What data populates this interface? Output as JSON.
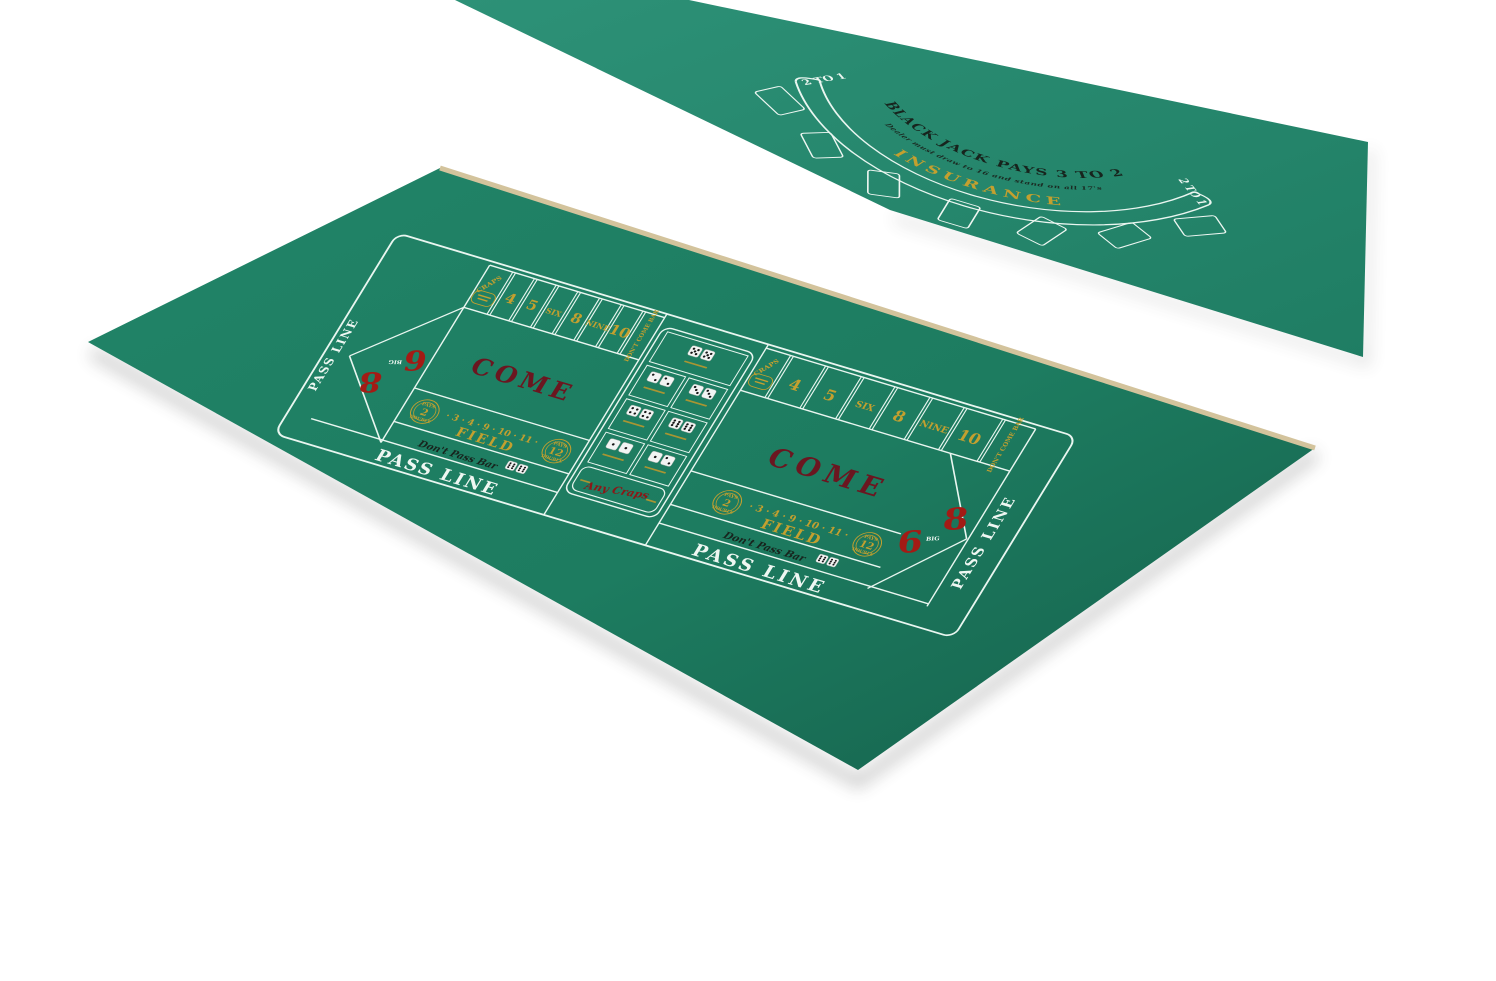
{
  "product": {
    "description": "Double-sided green felt casino tabletop layout: blackjack half and craps half"
  },
  "colors": {
    "background": "#ffffff",
    "blackjack_felt": "#23856a",
    "blackjack_felt_light": "#2d9177",
    "craps_felt": "#1d7c60",
    "craps_felt_dark": "#15604b",
    "line_white": "#e9f6f0",
    "gold": "#c3a02f",
    "red": "#a31b15",
    "maroon": "#6b1620",
    "print_black": "#17241d",
    "tan_edge": "#d3c39c",
    "dice_white": "#f2f4f3",
    "pip_black": "#161616"
  },
  "blackjack": {
    "title": "BLACK JACK PAYS 3 TO 2",
    "rule": "Dealer must draw to 16 and stand on all 17's",
    "insurance": "INSURANCE",
    "insurance_payout_left": "2 TO 1",
    "insurance_payout_right": "2 TO 1",
    "betting_spot_count": 7
  },
  "craps": {
    "pass_line": "PASS LINE",
    "come": "COME",
    "field_label": "FIELD",
    "field_numbers": "· 3 · 4 · 9 · 10 · 11 ·",
    "field_circle_left": {
      "pays": "PAYS",
      "value": "2",
      "double": "DOUBLE"
    },
    "field_circle_right": {
      "pays": "PAYS",
      "value": "12",
      "double": "DOUBLE"
    },
    "place_numbers": [
      "4",
      "5",
      "SIX",
      "8",
      "NINE",
      "10"
    ],
    "craps_box": "CRAPS",
    "dont_come": "DON'T COME BAR",
    "dont_pass": "Don't Pass Bar",
    "any_craps": "Any Craps",
    "big_six": "6",
    "big_eight": "8",
    "big_label": "BIG",
    "prop_dice": [
      [
        5,
        5
      ],
      [
        2,
        2
      ],
      [
        3,
        3
      ],
      [
        4,
        4
      ],
      [
        6,
        6
      ],
      [
        1,
        1
      ],
      [
        1,
        2
      ]
    ],
    "dont_pass_dice": [
      6,
      6
    ]
  }
}
